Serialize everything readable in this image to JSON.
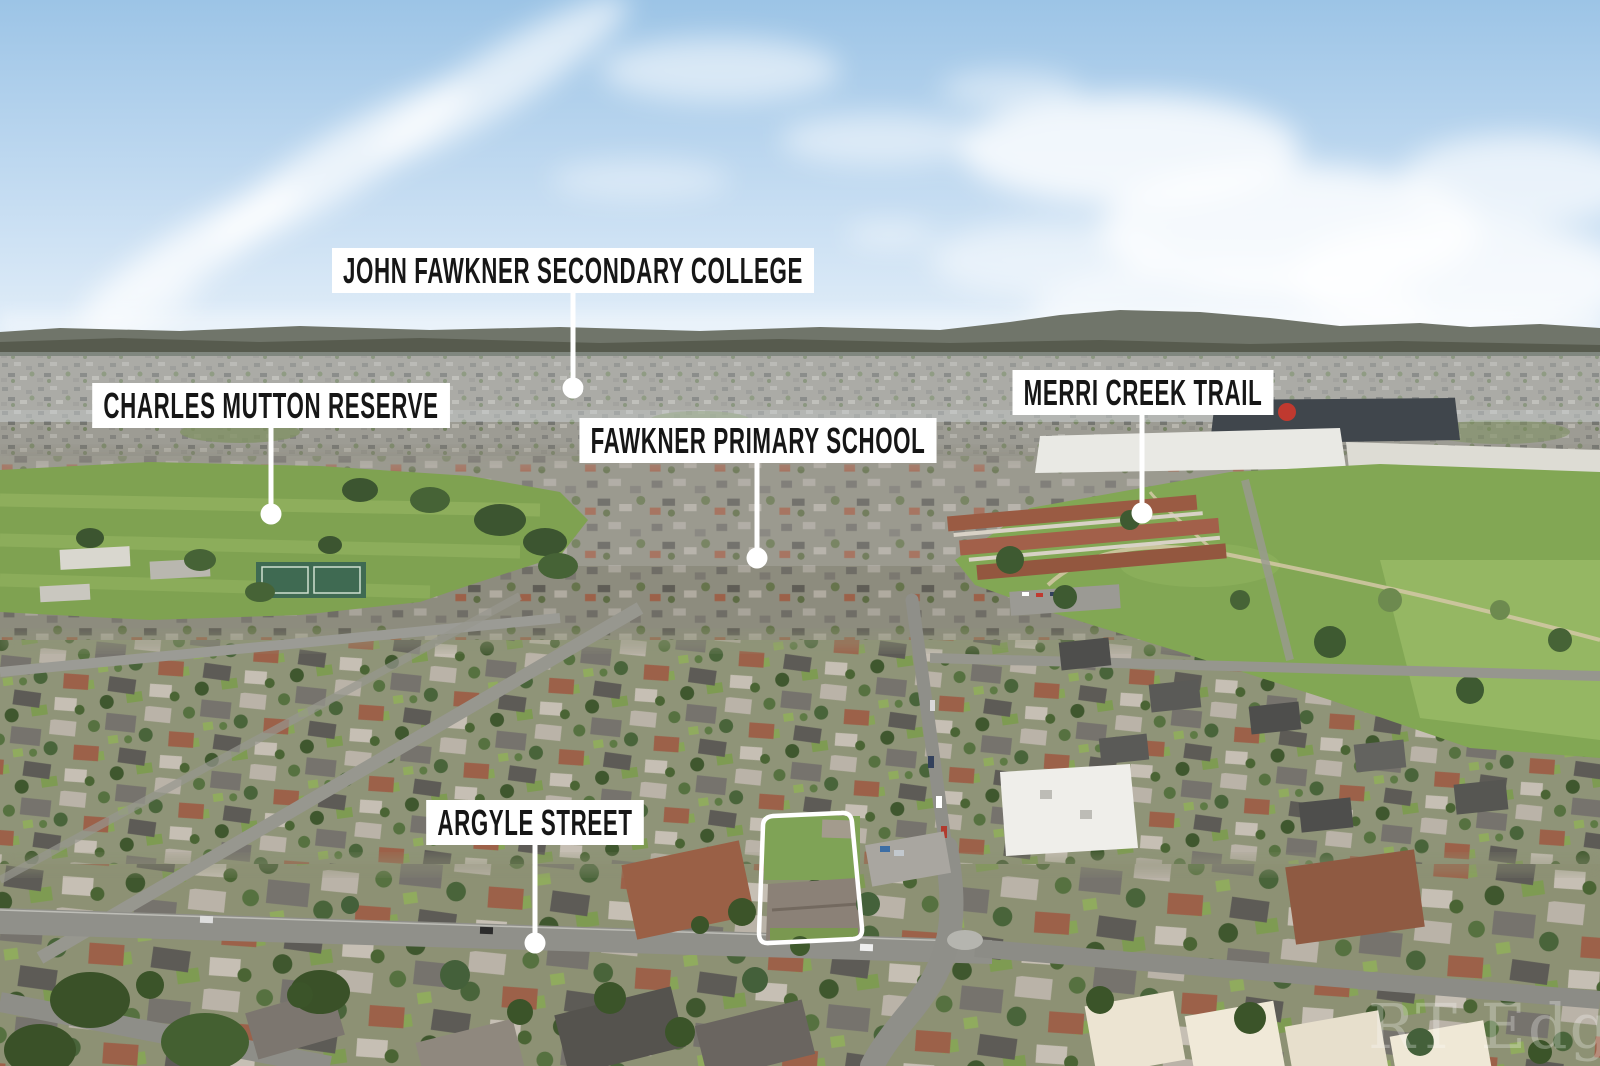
{
  "labels": [
    {
      "id": "john-fawkner-secondary-college",
      "text": "JOHN FAWKNER SECONDARY COLLEGE"
    },
    {
      "id": "charles-mutton-reserve",
      "text": "CHARLES MUTTON RESERVE"
    },
    {
      "id": "fawkner-primary-school",
      "text": "FAWKNER PRIMARY SCHOOL"
    },
    {
      "id": "merri-creek-trail",
      "text": "MERRI CREEK TRAIL"
    },
    {
      "id": "argyle-street",
      "text": "ARGYLE STREET"
    }
  ],
  "watermark": {
    "text": "RT Edgar"
  },
  "colors": {
    "label_background": "#ffffff",
    "label_text": "#161616",
    "marker": "#ffffff",
    "property_outline": "#ffffff",
    "sky_top": "#9cc4e6",
    "field_green": "#7fa251"
  }
}
